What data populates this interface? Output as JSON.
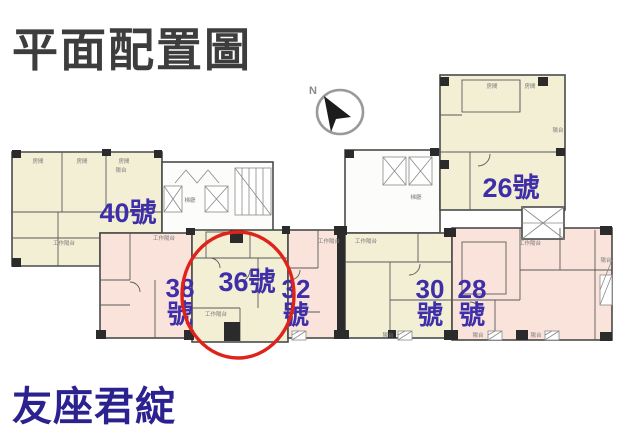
{
  "page": {
    "title": "平面配置圖",
    "project_name": "友座君綻"
  },
  "compass": {
    "north_label": "N"
  },
  "plan": {
    "highlighted_unit": "36號",
    "units": [
      {
        "id": "40",
        "line1": "40號",
        "line2": "",
        "zone_color": "#f2efd5"
      },
      {
        "id": "26",
        "line1": "26號",
        "line2": "",
        "zone_color": "#f2efd5"
      },
      {
        "id": "38",
        "line1": "38",
        "line2": "號",
        "zone_color": "#fae3da"
      },
      {
        "id": "36",
        "line1": "36號",
        "line2": "",
        "zone_color": "#f2efd5",
        "highlighted": true
      },
      {
        "id": "32",
        "line1": "32",
        "line2": "號",
        "zone_color": "#fae3da"
      },
      {
        "id": "30",
        "line1": "30",
        "line2": "號",
        "zone_color": "#f2efd5"
      },
      {
        "id": "28",
        "line1": "28",
        "line2": "號",
        "zone_color": "#fae3da"
      }
    ],
    "room_labels": [
      {
        "text": "房間"
      },
      {
        "text": "房間"
      },
      {
        "text": "房間"
      },
      {
        "text": "陽台"
      },
      {
        "text": "工作陽台"
      },
      {
        "text": "梯廳"
      },
      {
        "text": "工作陽台"
      },
      {
        "text": "工作陽台"
      },
      {
        "text": "工作陽台"
      },
      {
        "text": "工作陽台"
      },
      {
        "text": "梯廳"
      },
      {
        "text": "工作陽台"
      },
      {
        "text": "房間"
      },
      {
        "text": "房間"
      },
      {
        "text": "陽台"
      },
      {
        "text": "陽台"
      },
      {
        "text": "陽台"
      },
      {
        "text": "陽台"
      },
      {
        "text": "陽台"
      }
    ]
  },
  "colors": {
    "unit_label": "#3e2fa8",
    "highlight_ring": "#e0231a",
    "title_text": "#3d3d3d",
    "project_name_text": "#2b2290",
    "zone_cream": "#f2efd5",
    "zone_pink": "#fae3da",
    "wall": "#4a4a4a"
  }
}
